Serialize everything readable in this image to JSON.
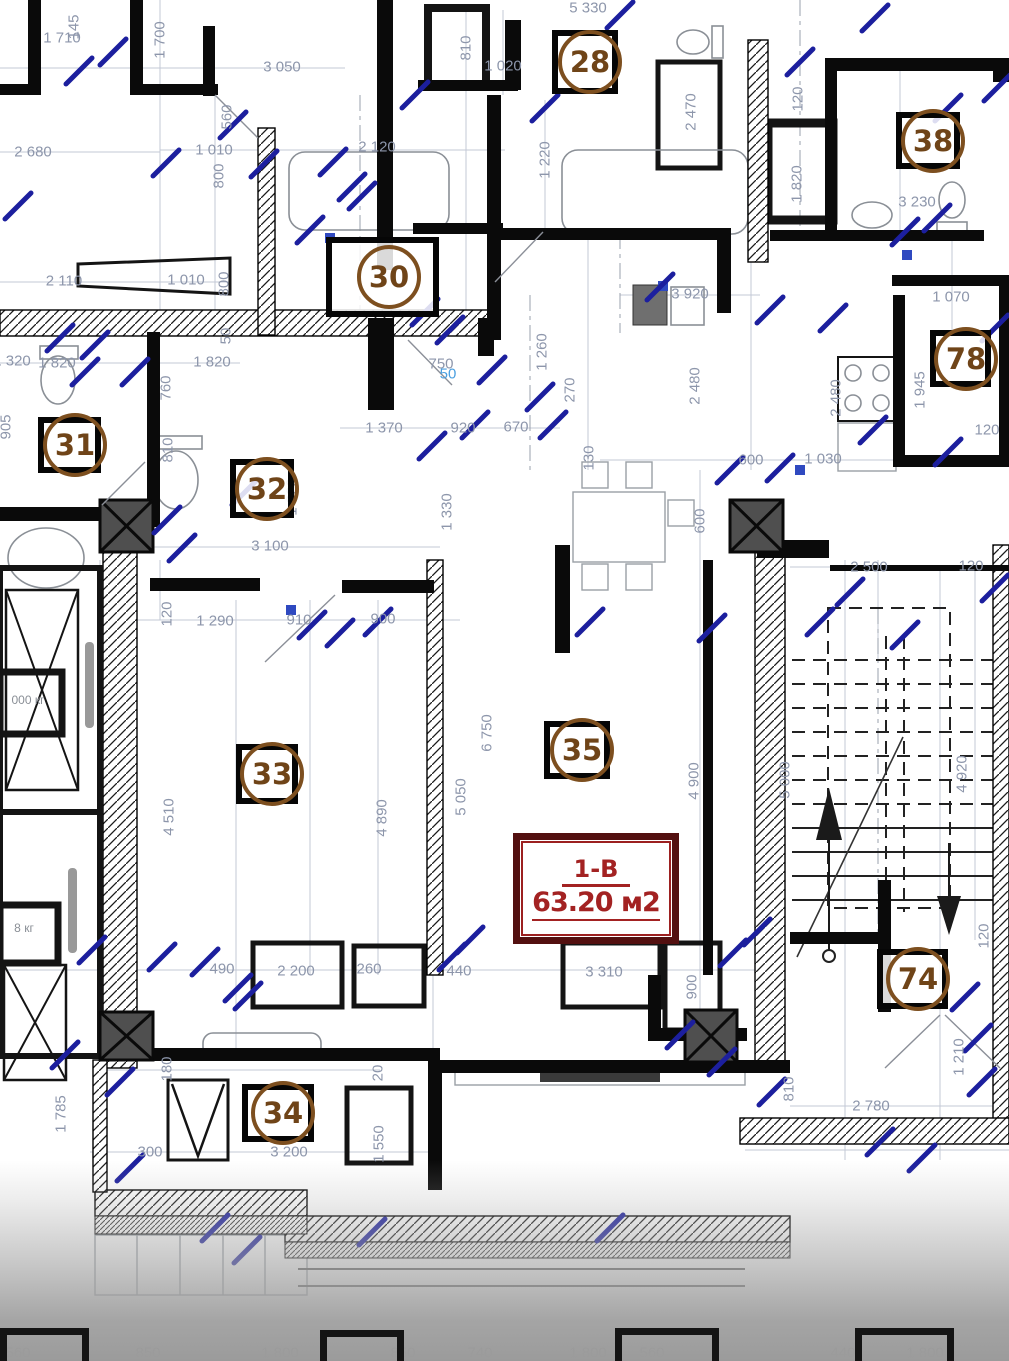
{
  "apartment_label": {
    "code": "1-В",
    "area": "63.20 м2"
  },
  "room_markers": [
    {
      "num": "28",
      "x": 552,
      "y": 30,
      "w": 66,
      "h": 64
    },
    {
      "num": "38",
      "x": 896,
      "y": 112,
      "w": 64,
      "h": 57
    },
    {
      "num": "30",
      "x": 326,
      "y": 237,
      "w": 113,
      "h": 80
    },
    {
      "num": "78",
      "x": 930,
      "y": 330,
      "w": 61,
      "h": 57
    },
    {
      "num": "31",
      "x": 38,
      "y": 417,
      "w": 63,
      "h": 56
    },
    {
      "num": "32",
      "x": 230,
      "y": 459,
      "w": 64,
      "h": 59
    },
    {
      "num": "33",
      "x": 236,
      "y": 744,
      "w": 62,
      "h": 60
    },
    {
      "num": "35",
      "x": 544,
      "y": 721,
      "w": 66,
      "h": 58
    },
    {
      "num": "34",
      "x": 242,
      "y": 1084,
      "w": 72,
      "h": 58
    },
    {
      "num": "74",
      "x": 877,
      "y": 949,
      "w": 71,
      "h": 60
    }
  ],
  "dimension_labels": [
    {
      "t": "1 710",
      "x": 62,
      "y": 38
    },
    {
      "t": "145",
      "x": 74,
      "y": 27,
      "r": 1
    },
    {
      "t": "1 700",
      "x": 160,
      "y": 40,
      "r": 1
    },
    {
      "t": "3 050",
      "x": 282,
      "y": 67
    },
    {
      "t": "5 330",
      "x": 588,
      "y": 8
    },
    {
      "t": "810",
      "x": 466,
      "y": 48,
      "r": 1
    },
    {
      "t": "1 020",
      "x": 503,
      "y": 66
    },
    {
      "t": "2 470",
      "x": 691,
      "y": 112,
      "r": 1
    },
    {
      "t": "1 220",
      "x": 545,
      "y": 160,
      "r": 1
    },
    {
      "t": "120",
      "x": 798,
      "y": 99,
      "r": 1
    },
    {
      "t": "1 820",
      "x": 797,
      "y": 184,
      "r": 1
    },
    {
      "t": "3 230",
      "x": 917,
      "y": 202
    },
    {
      "t": "2 680",
      "x": 33,
      "y": 152
    },
    {
      "t": "1 010",
      "x": 214,
      "y": 150
    },
    {
      "t": "800",
      "x": 219,
      "y": 176,
      "r": 1
    },
    {
      "t": "560",
      "x": 227,
      "y": 117,
      "r": 1
    },
    {
      "t": "2 110",
      "x": 64,
      "y": 281
    },
    {
      "t": "1 010",
      "x": 186,
      "y": 280
    },
    {
      "t": "800",
      "x": 224,
      "y": 284,
      "r": 1
    },
    {
      "t": "2 120",
      "x": 377,
      "y": 147
    },
    {
      "t": "1 320",
      "x": 12,
      "y": 361
    },
    {
      "t": "1 820",
      "x": 57,
      "y": 363
    },
    {
      "t": "1 820",
      "x": 212,
      "y": 362
    },
    {
      "t": "905",
      "x": 6,
      "y": 427,
      "r": 1
    },
    {
      "t": "760",
      "x": 166,
      "y": 388,
      "r": 1
    },
    {
      "t": "810",
      "x": 168,
      "y": 450,
      "r": 1
    },
    {
      "t": "50",
      "x": 226,
      "y": 336,
      "r": 1
    },
    {
      "t": "1 370",
      "x": 384,
      "y": 428
    },
    {
      "t": "920",
      "x": 463,
      "y": 428
    },
    {
      "t": "670",
      "x": 516,
      "y": 427
    },
    {
      "t": "750",
      "x": 441,
      "y": 364
    },
    {
      "t": "50",
      "x": 448,
      "y": 374,
      "c": "#4a9fe0"
    },
    {
      "t": "1 260",
      "x": 542,
      "y": 352,
      "r": 1
    },
    {
      "t": "270",
      "x": 570,
      "y": 390,
      "r": 1
    },
    {
      "t": "3 920",
      "x": 690,
      "y": 294
    },
    {
      "t": "2 480",
      "x": 695,
      "y": 386,
      "r": 1
    },
    {
      "t": "130",
      "x": 589,
      "y": 458,
      "r": 1
    },
    {
      "t": "600",
      "x": 751,
      "y": 460
    },
    {
      "t": "1 030",
      "x": 823,
      "y": 459
    },
    {
      "t": "2 480",
      "x": 836,
      "y": 398,
      "r": 1
    },
    {
      "t": "1 070",
      "x": 951,
      "y": 297
    },
    {
      "t": "1 945",
      "x": 920,
      "y": 390,
      "r": 1
    },
    {
      "t": "120",
      "x": 987,
      "y": 430
    },
    {
      "t": "1 820",
      "x": 292,
      "y": 497,
      "r": 1
    },
    {
      "t": "1 330",
      "x": 447,
      "y": 512,
      "r": 1
    },
    {
      "t": "600",
      "x": 700,
      "y": 521,
      "r": 1
    },
    {
      "t": "3 100",
      "x": 270,
      "y": 546
    },
    {
      "t": "2 500",
      "x": 869,
      "y": 567
    },
    {
      "t": "120",
      "x": 971,
      "y": 566
    },
    {
      "t": "120",
      "x": 167,
      "y": 614,
      "r": 1
    },
    {
      "t": "1 290",
      "x": 215,
      "y": 621
    },
    {
      "t": "910",
      "x": 299,
      "y": 620
    },
    {
      "t": "900",
      "x": 383,
      "y": 619
    },
    {
      "t": "6 750",
      "x": 487,
      "y": 733,
      "r": 1
    },
    {
      "t": "5 050",
      "x": 461,
      "y": 797,
      "r": 1
    },
    {
      "t": "4 510",
      "x": 169,
      "y": 817,
      "r": 1
    },
    {
      "t": "4 890",
      "x": 382,
      "y": 818,
      "r": 1
    },
    {
      "t": "4 900",
      "x": 694,
      "y": 781,
      "r": 1
    },
    {
      "t": "5 000",
      "x": 785,
      "y": 780,
      "r": 1
    },
    {
      "t": "4 920",
      "x": 962,
      "y": 774,
      "r": 1
    },
    {
      "t": "490",
      "x": 222,
      "y": 969
    },
    {
      "t": "2 200",
      "x": 296,
      "y": 971
    },
    {
      "t": "260",
      "x": 369,
      "y": 969
    },
    {
      "t": "440",
      "x": 459,
      "y": 971
    },
    {
      "t": "3 310",
      "x": 604,
      "y": 972
    },
    {
      "t": "900",
      "x": 692,
      "y": 987,
      "r": 1
    },
    {
      "t": "1 785",
      "x": 61,
      "y": 1114,
      "r": 1
    },
    {
      "t": "300",
      "x": 150,
      "y": 1152
    },
    {
      "t": "180",
      "x": 167,
      "y": 1069,
      "r": 1
    },
    {
      "t": "3 200",
      "x": 289,
      "y": 1152
    },
    {
      "t": "1 550",
      "x": 379,
      "y": 1144,
      "r": 1
    },
    {
      "t": "20",
      "x": 378,
      "y": 1073,
      "r": 1
    },
    {
      "t": "2 780",
      "x": 871,
      "y": 1106
    },
    {
      "t": "1 210",
      "x": 959,
      "y": 1057,
      "r": 1
    },
    {
      "t": "120",
      "x": 984,
      "y": 936,
      "r": 1
    },
    {
      "t": "810",
      "x": 789,
      "y": 1089,
      "r": 1
    }
  ],
  "elevator_labels": [
    {
      "text": "000 кг",
      "x": 28,
      "y": 700
    },
    {
      "text": "8 кг",
      "x": 24,
      "y": 928
    }
  ],
  "bottom_edge_dimensions": [
    {
      "t": "560",
      "x": 18
    },
    {
      "t": "850",
      "x": 148
    },
    {
      "t": "1 800",
      "x": 280
    },
    {
      "t": "850",
      "x": 403
    },
    {
      "t": "740",
      "x": 480
    },
    {
      "t": "1 800",
      "x": 588
    },
    {
      "t": "560",
      "x": 652
    },
    {
      "t": "440",
      "x": 843
    },
    {
      "t": "1 800",
      "x": 925
    }
  ],
  "colors": {
    "dimension_text": "#8d96ab",
    "tick_blue": "#1c1f9e",
    "marker_brown": "#7d4f1f",
    "apartment_red": "#a32222",
    "wall_black": "#0a0a0a"
  }
}
